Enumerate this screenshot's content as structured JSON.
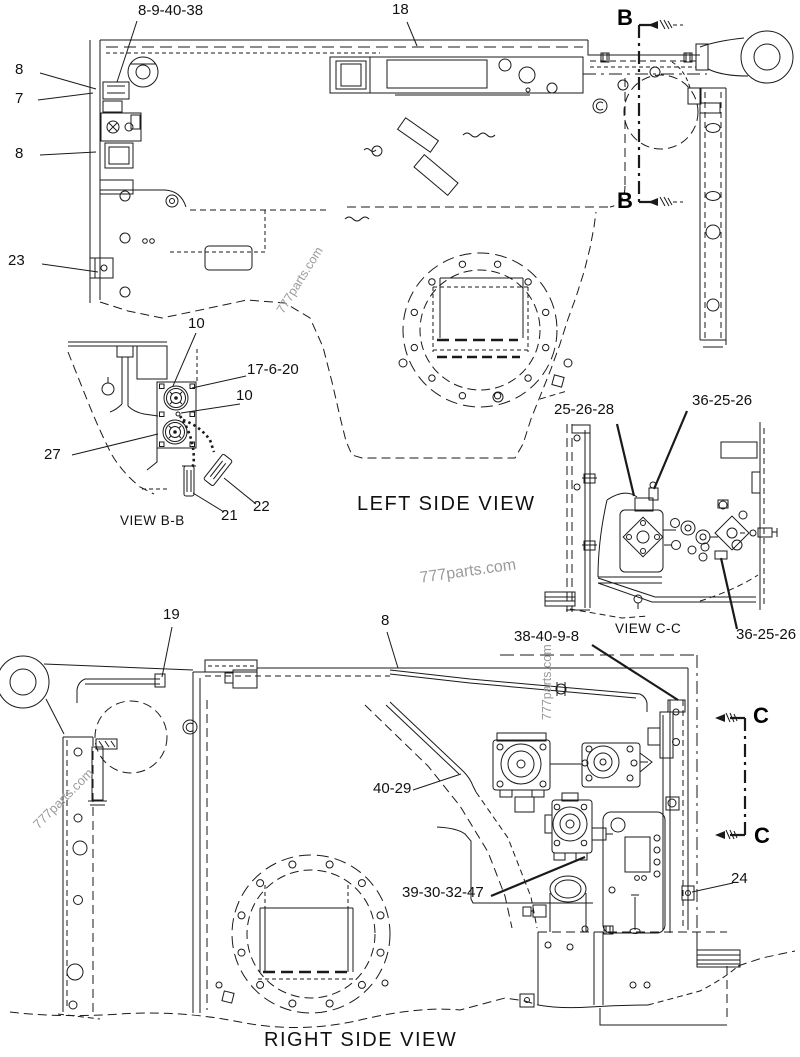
{
  "page": {
    "background": "#ffffff",
    "ink": "#1a1a1a",
    "watermark_color": "#9b9b9b"
  },
  "watermark": {
    "text": "777parts.com"
  },
  "section_markers": {
    "b": "B",
    "c": "C"
  },
  "views": {
    "left": {
      "title": "LEFT SIDE VIEW",
      "callouts": {
        "assembly": "8-9-40-38",
        "grille": "18",
        "bolt_top": "8",
        "bracket": "7",
        "bolt_mid": "8",
        "clip": "23"
      }
    },
    "bb": {
      "title": "VIEW B-B",
      "callouts": {
        "connector_top": "10",
        "plate": "17-6-20",
        "connector_mid": "10",
        "lower": "27",
        "cap_left": "21",
        "cap_right": "22"
      }
    },
    "cc": {
      "title": "VIEW C-C",
      "callouts": {
        "group_left": "25-26-28",
        "group_top": "36-25-26",
        "group_bottom": "36-25-26"
      }
    },
    "right": {
      "title": "RIGHT SIDE VIEW",
      "callouts": {
        "rail": "19",
        "pipe": "8",
        "harness_top": "38-40-9-8",
        "harness_mid": "40-29",
        "pump_group": "39-30-32-47",
        "bracket": "24"
      }
    }
  }
}
